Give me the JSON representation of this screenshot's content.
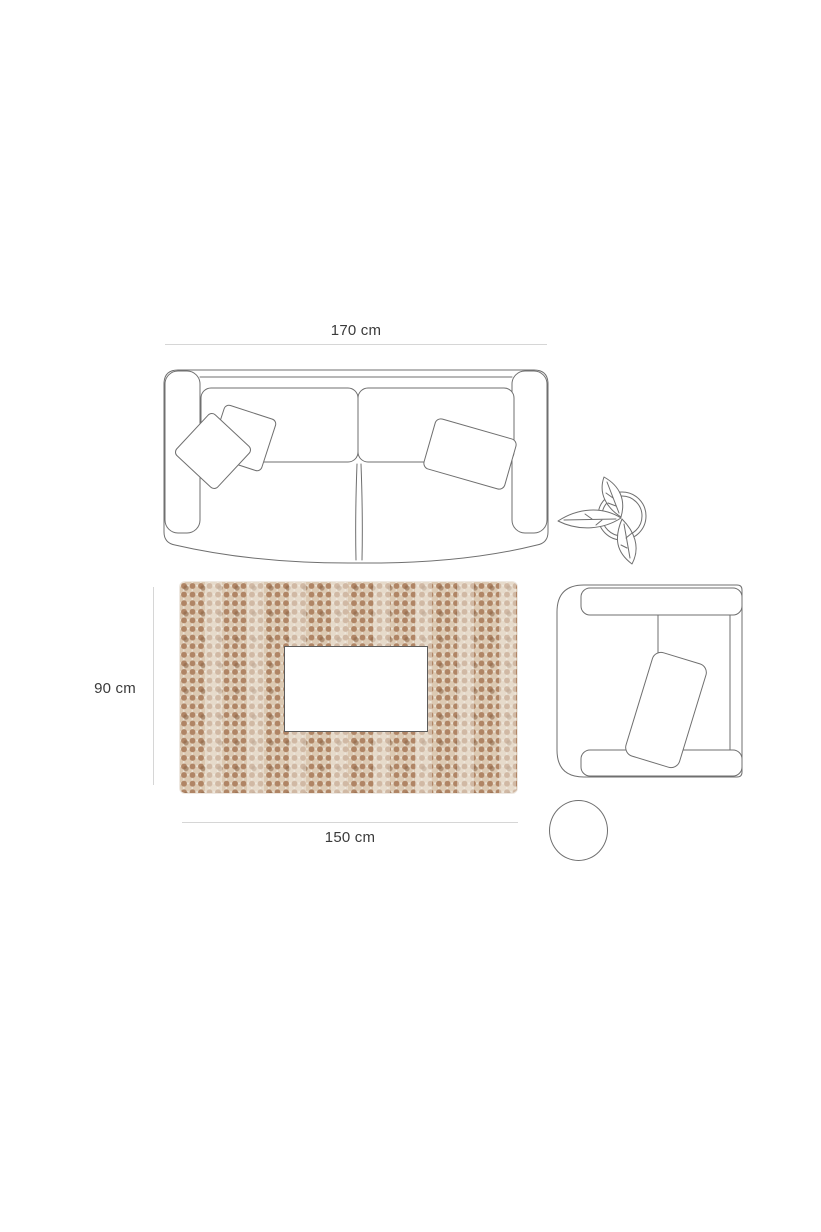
{
  "labels": {
    "sofa_width": "170 cm",
    "rug_height": "90 cm",
    "rug_width": "150 cm"
  },
  "items": [
    {
      "name": "sofa-top-view",
      "kind": "two-seat sofa with three pillows"
    },
    {
      "name": "plant-top-view",
      "kind": "potted plant with three leaves"
    },
    {
      "name": "rug-top-view",
      "kind": "beige bobble-dot rug"
    },
    {
      "name": "coffee-table-top-view",
      "kind": "rectangular coffee table"
    },
    {
      "name": "armchair-top-view",
      "kind": "armchair with cushion"
    },
    {
      "name": "side-table-top-view",
      "kind": "round side table"
    }
  ],
  "colors": {
    "background": "#ffffff",
    "furniture_line": "#6f6f6f",
    "dimension_line": "#d6d6d6",
    "label_text": "#3b3b3b",
    "rug_base": "#ece5d8",
    "rug_dot_brown": "#b08565",
    "rug_dot_light": "#dcc9b2",
    "table_border": "#5c5c5c"
  }
}
